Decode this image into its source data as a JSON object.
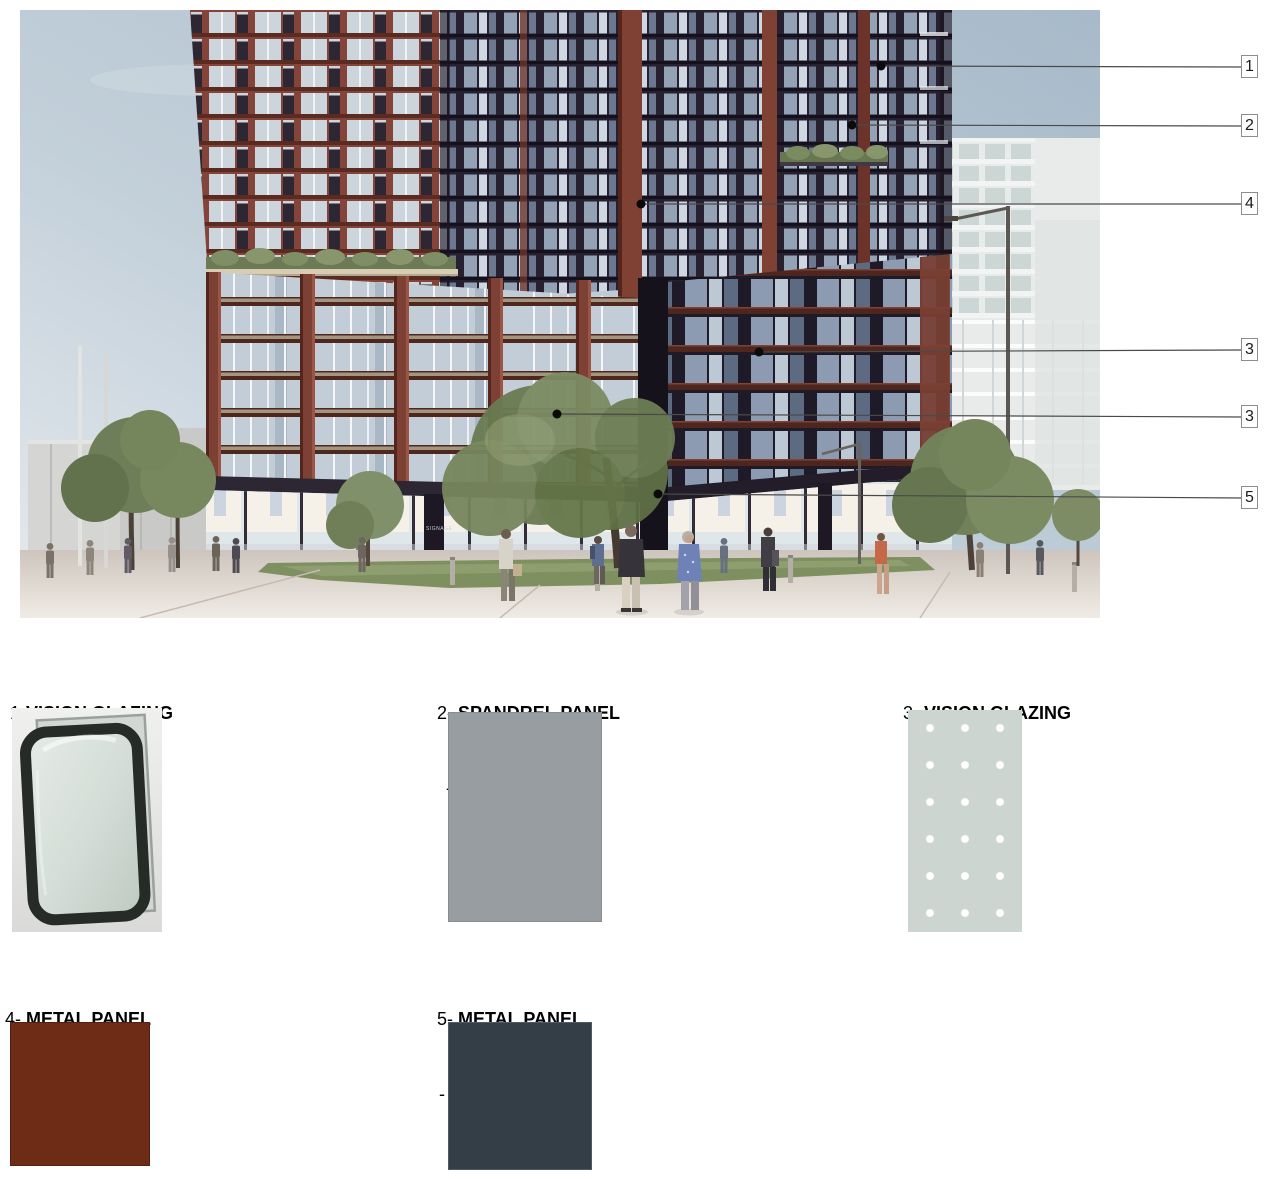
{
  "rendering": {
    "description": "Street-level rendering of a mixed-use residential tower with red-oxide metal frames, dark metal panels, glazed podium and retail base on a pedestrian plaza",
    "signage_text": "SIGNAGE",
    "colors": {
      "sky": "#aebfce",
      "metal_red_frame": "#7d4134",
      "dark_panel": "#241f2a",
      "glass": "#c5cfd8"
    }
  },
  "callouts": [
    {
      "label": "1"
    },
    {
      "label": "2"
    },
    {
      "label": "4"
    },
    {
      "label": "3"
    },
    {
      "label": "3"
    },
    {
      "label": "5"
    }
  ],
  "legend": {
    "items": [
      {
        "prefix": "1-",
        "name": "VISION GLAZING",
        "detail": "- CLEAR",
        "swatch": "glass-photo"
      },
      {
        "prefix": "2- ",
        "name": "SPANDREL PANEL",
        "detail": "- LIGHT",
        "swatch": "color",
        "color": "#989da2"
      },
      {
        "prefix": "3- ",
        "name": "VISION GLAZING",
        "detail": "- FRITT",
        "swatch": "fritted",
        "color": "#ccd5d0",
        "dot_color": "#ffffff"
      },
      {
        "prefix": "4- ",
        "name": "METAL PANEL",
        "detail": "- LIGHT",
        "swatch": "color",
        "color": "#6e2b15"
      },
      {
        "prefix": "5- ",
        "name": "METAL PANEL",
        "detail": "- DARK",
        "swatch": "color",
        "color": "#333e46"
      }
    ]
  }
}
